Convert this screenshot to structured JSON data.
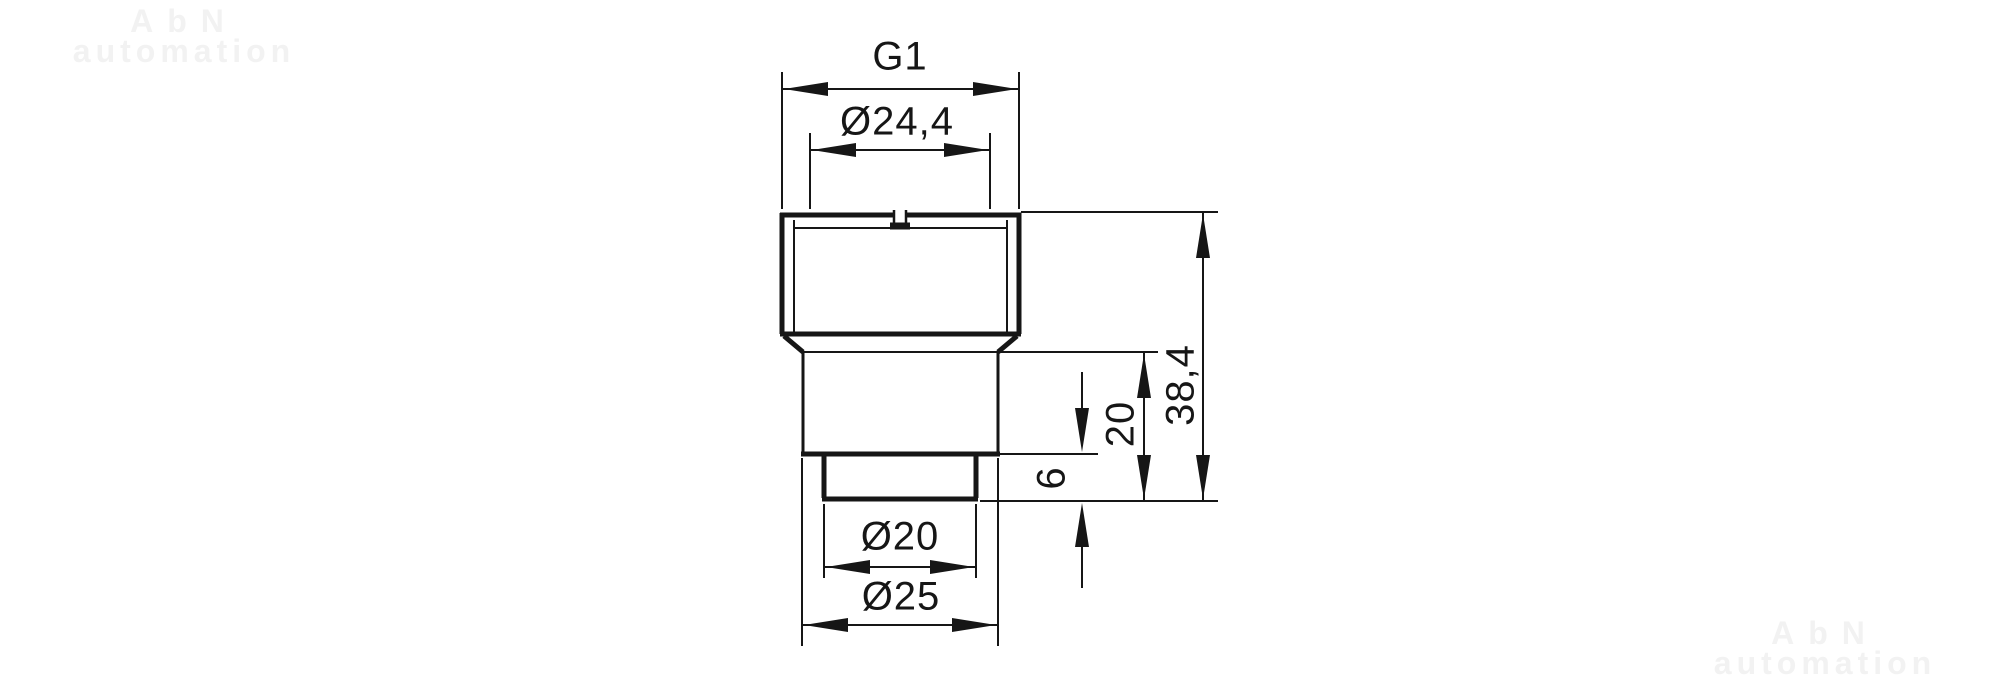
{
  "drawing": {
    "type": "technical-dimension-drawing",
    "part": "threaded adapter, front section view",
    "labels": {
      "thread": "G1",
      "bore_diameter": "Ø24,4",
      "total_height": "38,4",
      "lower_height": "20",
      "spigot_height": "6",
      "spigot_diameter": "Ø20",
      "collar_diameter": "Ø25"
    },
    "colors": {
      "line": "#161616",
      "background": "#ffffff",
      "watermark": "#f2f2f2"
    }
  },
  "watermark": {
    "line1": "AbN",
    "line2": "automation"
  }
}
